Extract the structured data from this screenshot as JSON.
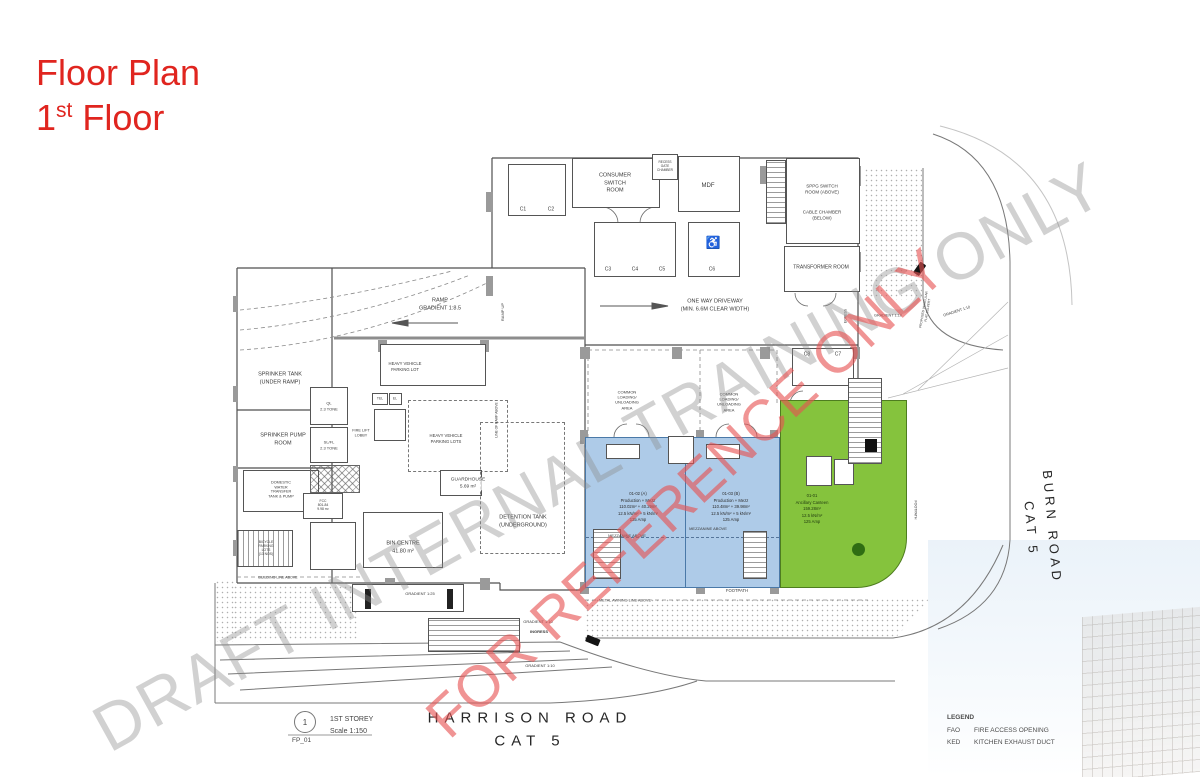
{
  "title": {
    "line1": "Floor Plan",
    "line2_num": "1",
    "line2_sup": "st",
    "line2_rest": " Floor"
  },
  "watermarks": {
    "draft": "DRAFT INTERNAL TRAINING ONLY",
    "reference": "FOR REFERENCE ONLY"
  },
  "roads": {
    "harrison": "HARRISON ROAD\nCAT 5",
    "burn": "BURN ROAD\nCAT 5"
  },
  "sheet": {
    "number": "1",
    "code": "FP_01",
    "storey": "1ST STOREY",
    "scale": "Scale 1:150"
  },
  "legend": {
    "title": "LEGEND",
    "fao_abbr": "FAO",
    "fao_desc": "FIRE ACCESS OPENING",
    "ked_abbr": "KED",
    "ked_desc": "KITCHEN EXHAUST DUCT"
  },
  "rooms": {
    "consumer_switch": "CONSUMER\nSWITCH\nROOM",
    "mdf": "MDF",
    "meter_chamber": "RECESS\nGATE\nCHAMBER",
    "sppg": "SPPG SWITCH\nROOM (ABOVE)",
    "cable": "CABLE CHAMBER\n(BELOW)",
    "transformer": "TRANSFORMER ROOM",
    "sprinkler_tank": "SPRINKER TANK\n(UNDER RAMP)",
    "sprinkler_pump": "SPRINKER PUMP\nROOM",
    "domestic_water": "DOMESTIC\nWATER\nTRANSFER\nTANK & PUMP",
    "bicycle": "BICYCLE\nPARKING\nLOTS\n(13 NOS)",
    "fcc": "FCC\n801-84\n9.98 m²",
    "guardhouse": "GUARDHOUSE\n5.69 m²",
    "detention": "DETENTION TANK\n(UNDERGROUND)",
    "bin_centre": "BIN CENTRE\n41.80 m²",
    "lift_ql": "QL\n2.3 TONE",
    "lift_slfl": "SL/FL\n2.3 TONE",
    "fire_lift_lobby": "FIRE LIFT\nLOBBY",
    "tel": "TEL",
    "el": "EL"
  },
  "units": {
    "a": "01-02 (A)\nProduction + Mezz\n110.02m² + 40.29m²\n12.5 kN/m² + 5 kN/m²\n125 Amp",
    "b": "01-03 (B)\nProduction + Mezz\n110.48m² + 39.98m²\n12.5 kN/m² + 5 kN/m²\n125 Amp",
    "canteen": "01-01\nAncillary Canteen\n159.28m²\n12.5 kN/m²\n125 Amp",
    "mezzanine": "MEZZANINE ABOVE"
  },
  "site": {
    "one_way": "ONE WAY DRIVEWAY\n(MIN. 6.6M CLEAR WIDTH)",
    "ramp": "RAMP\nGRADIENT 1:8.5",
    "ramp_up": "RAMP UP",
    "ramp_line": "LINE OF RAMP ABOVE",
    "hv_lot": "HEAVY VEHICLE\nPARKING LOT",
    "hv_lots": "HEAVY VEHICLE\nPARKING LOTS",
    "common_loading": "COMMON\nLOADING/\nUNLOADING\nAREA",
    "footpath": "FOOTPATH",
    "footpath_v": "FOOTPATH",
    "metal_awning": "METAL AWNING LINE ABOVE",
    "building_line": "BUILDING LINE ABOVE",
    "gradient_125": "GRADIENT 1:25",
    "gradient_110": "GRADIENT 1:10",
    "ingress": "INGRESS",
    "egress": "EGRESS",
    "culvert": "PROPOSED VEHICULAR\nFLAT CULVERT"
  },
  "parking": {
    "c1": "C1",
    "c2": "C2",
    "c3": "C3",
    "c4": "C4",
    "c5": "C5",
    "c6": "C6",
    "c7": "C7",
    "c8": "C8"
  },
  "icons": {
    "accessible": "♿"
  },
  "colors": {
    "unit_blue": "#aecbe8",
    "unit_green": "#85c33d",
    "title_red": "#e0251f"
  }
}
